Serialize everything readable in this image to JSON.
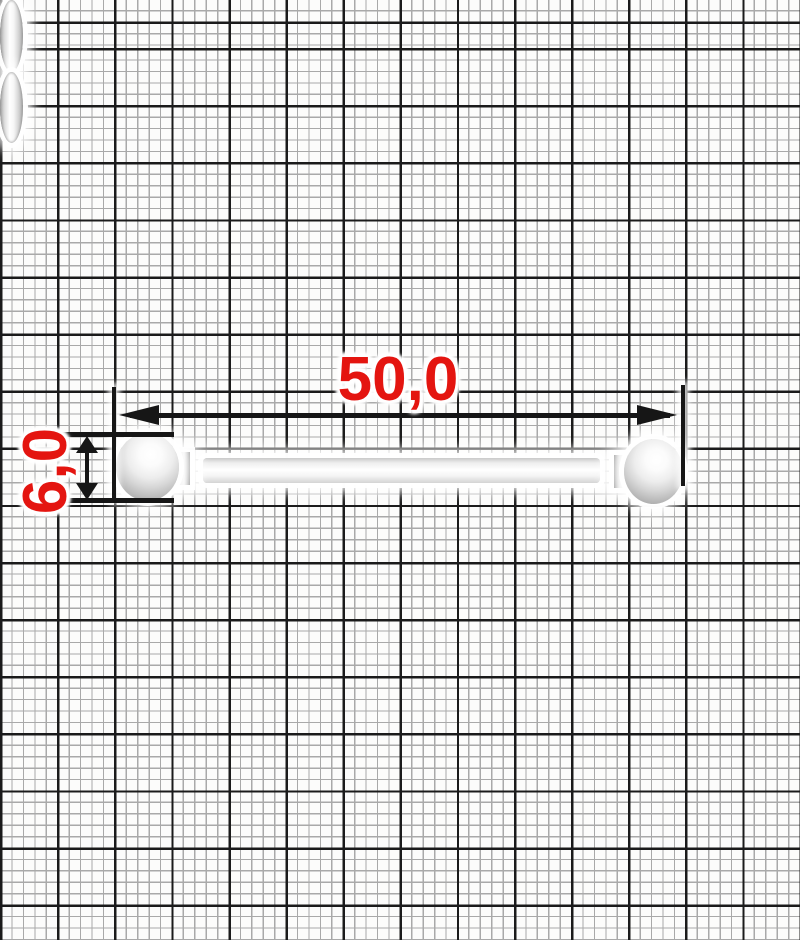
{
  "dimensions": {
    "length": "50,0",
    "diameter": "6,0"
  },
  "colors": {
    "annotation_red": "#e41510",
    "line_black": "#161616",
    "grid_bold": "#1b1b1b",
    "grid_fine": "#a9a9a9",
    "paper": "#fcfcfb"
  },
  "icons": {
    "arrowhead_left": "css-triangle-left",
    "arrowhead_right": "css-triangle-right",
    "arrowhead_up": "css-triangle-up",
    "arrowhead_down": "css-triangle-down"
  },
  "object": {
    "parts": [
      "left-ball",
      "left-collar",
      "left-washer",
      "shaft",
      "right-washer",
      "right-collar",
      "right-ball"
    ]
  }
}
